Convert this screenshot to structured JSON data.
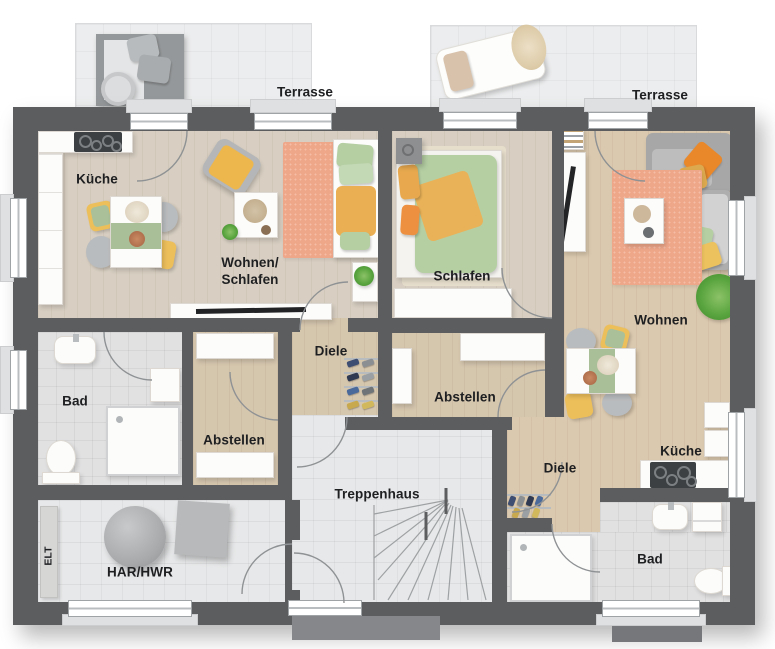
{
  "floor_plan": {
    "rooms": {
      "terrace_left": "Terrasse",
      "terrace_right": "Terrasse",
      "kitchen_left": "Küche",
      "living_sleeping": "Wohnen/\nSchlafen",
      "sleeping": "Schlafen",
      "living": "Wohnen",
      "hall_left": "Diele",
      "bath_left": "Bad",
      "storage_left": "Abstellen",
      "storage_right": "Abstellen",
      "stairwell": "Treppenhaus",
      "utility": "HAR/HWR",
      "electrical": "ELT",
      "hall_right": "Diele",
      "kitchen_right": "Küche",
      "bath_right": "Bad"
    },
    "colors": {
      "wall": "#5b5d5f",
      "wood_light": "#d8cfc2",
      "wood_tan": "#dbc9af",
      "tile": "#e7e8e9",
      "terrace": "#ecedee",
      "rug_salmon": "#efa78a",
      "sofa_gray": "#aeb0b2",
      "accent_orange": "#e8882b",
      "accent_yellow": "#edbf5b",
      "accent_green": "#b5cfa3"
    }
  }
}
